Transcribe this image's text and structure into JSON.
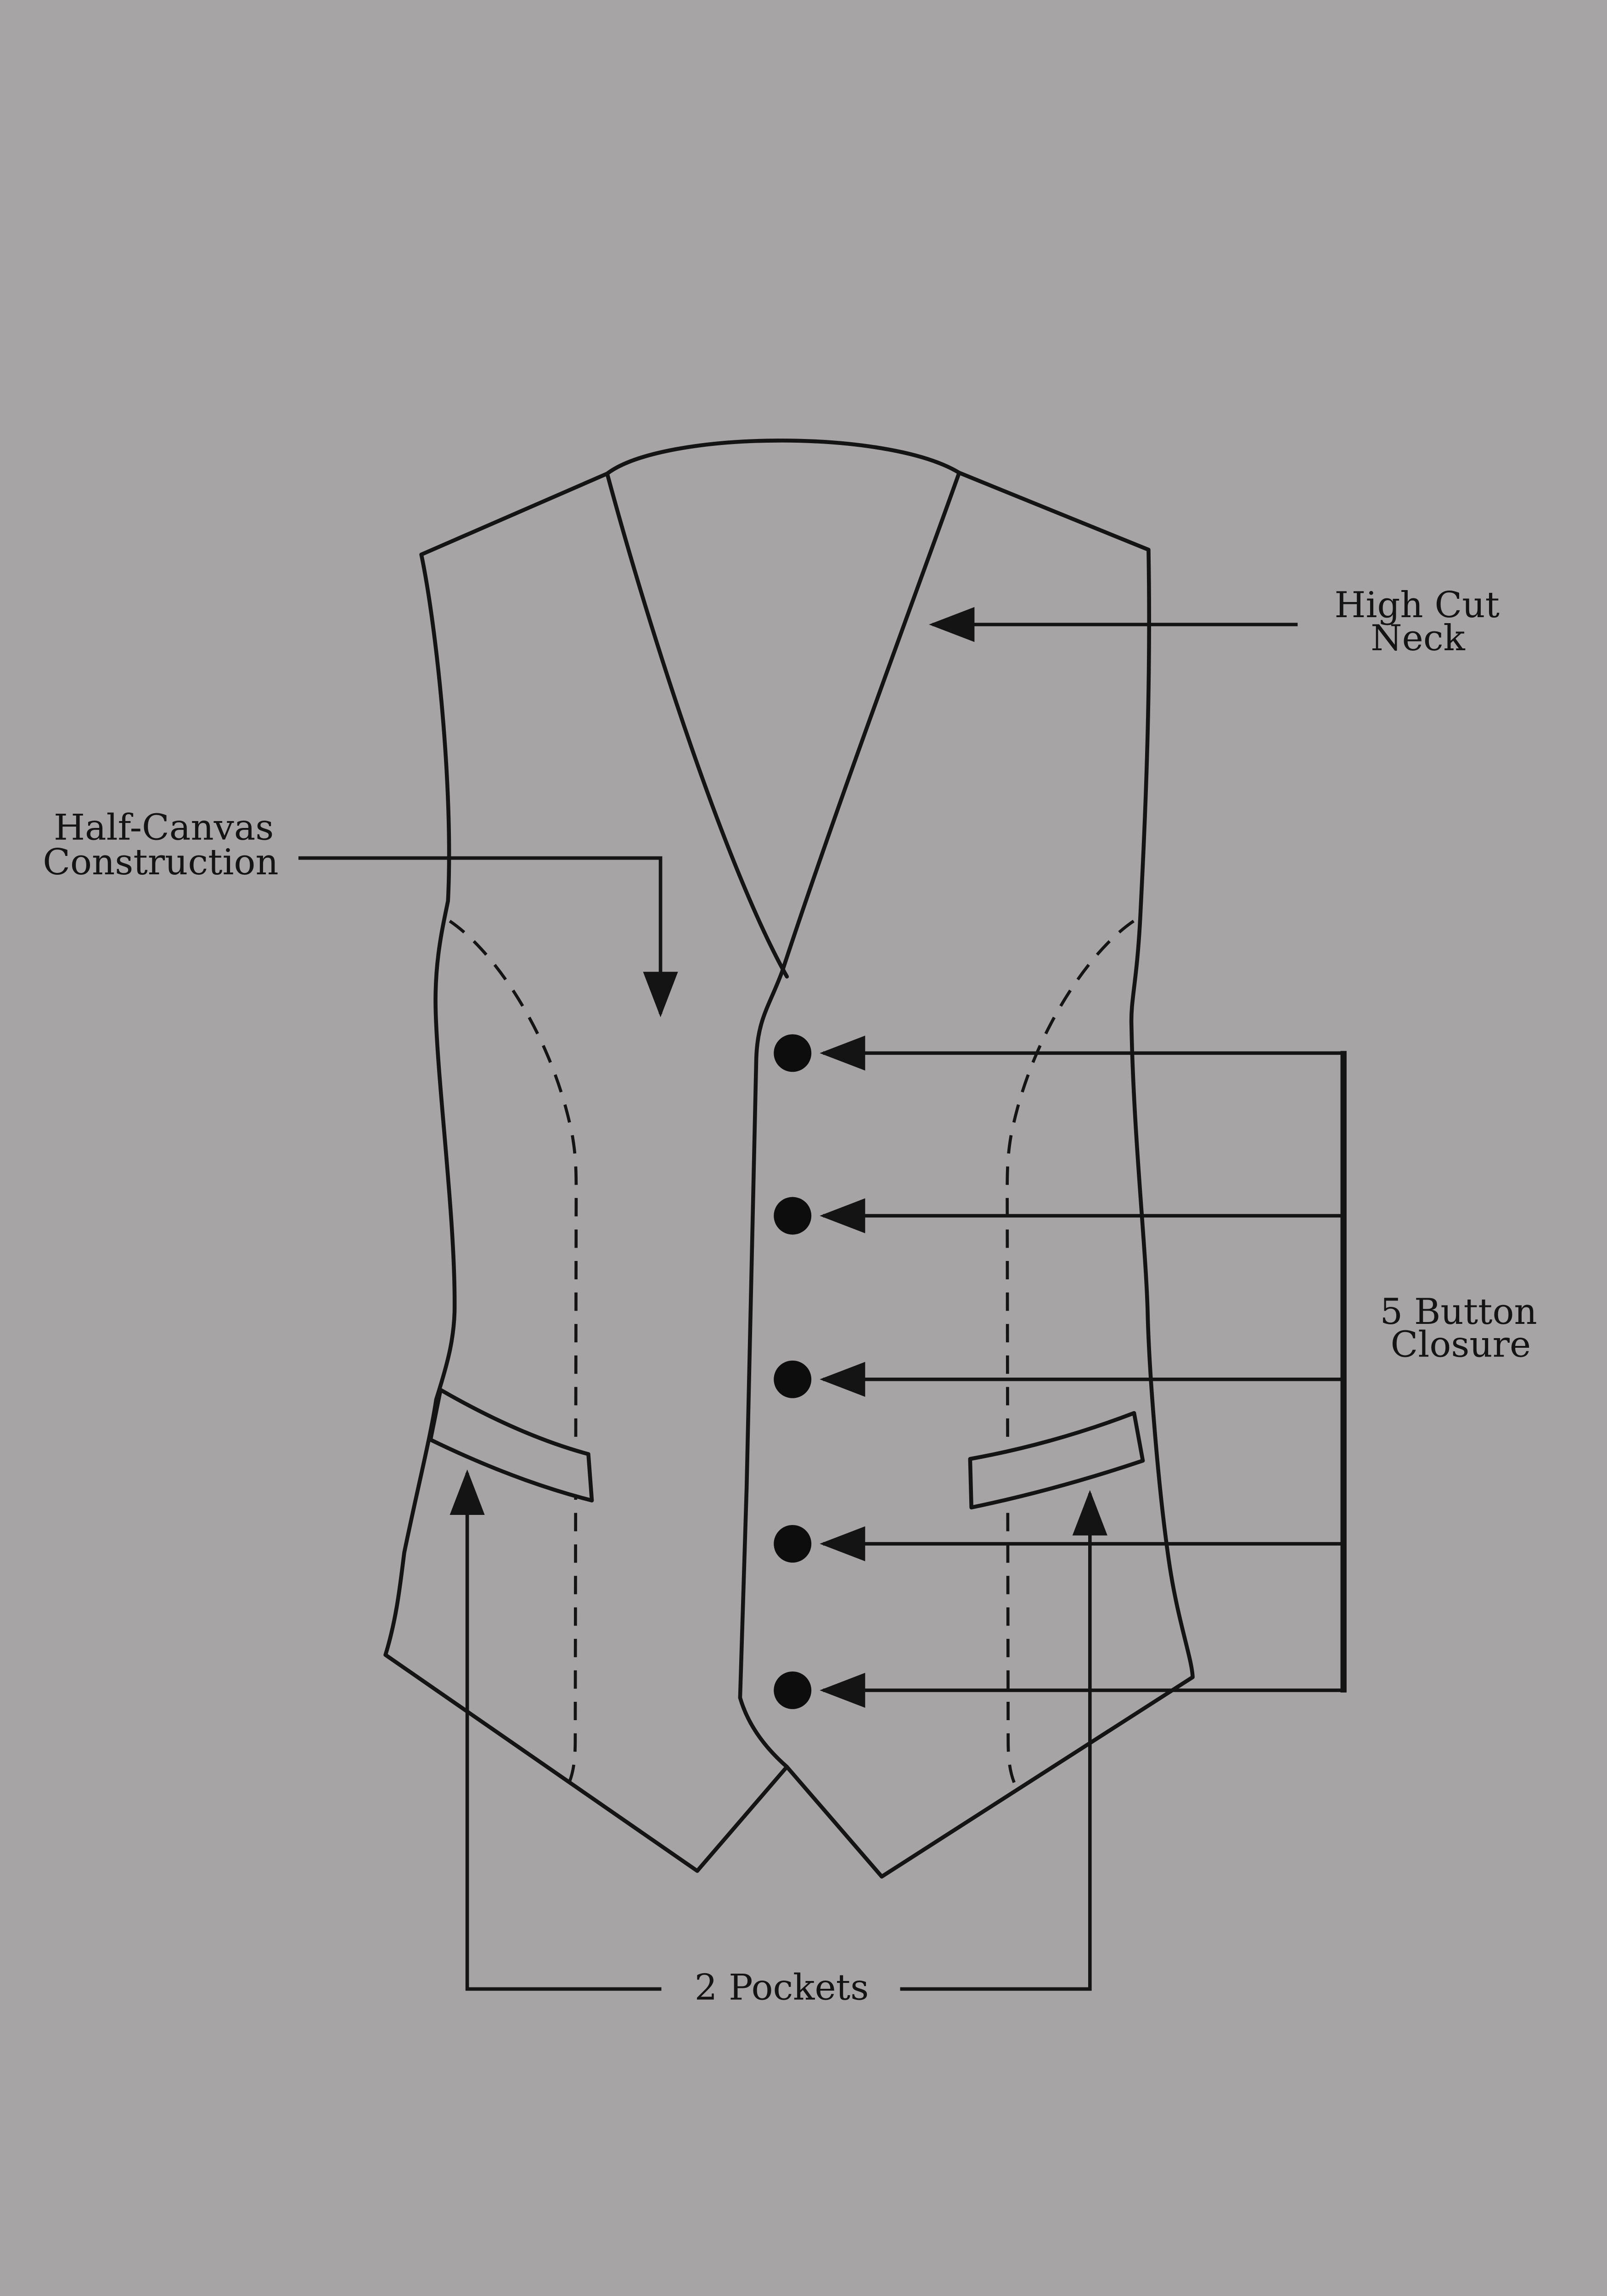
{
  "diagram": {
    "subject": "vest-construction-diagram",
    "labels": {
      "high_cut_neck": {
        "line1": "High Cut",
        "line2": "Neck"
      },
      "half_canvas": {
        "line1": "Half-Canvas",
        "line2": "Construction"
      },
      "button_closure": {
        "line1": "5 Button",
        "line2": "Closure"
      },
      "pockets": {
        "text": "2 Pockets"
      }
    },
    "features": {
      "button_count": 5,
      "pocket_count": 2
    },
    "colors": {
      "background": "#a6a4a5",
      "line": "#141414",
      "text": "#141414",
      "button_fill": "#0d0d0d"
    }
  }
}
